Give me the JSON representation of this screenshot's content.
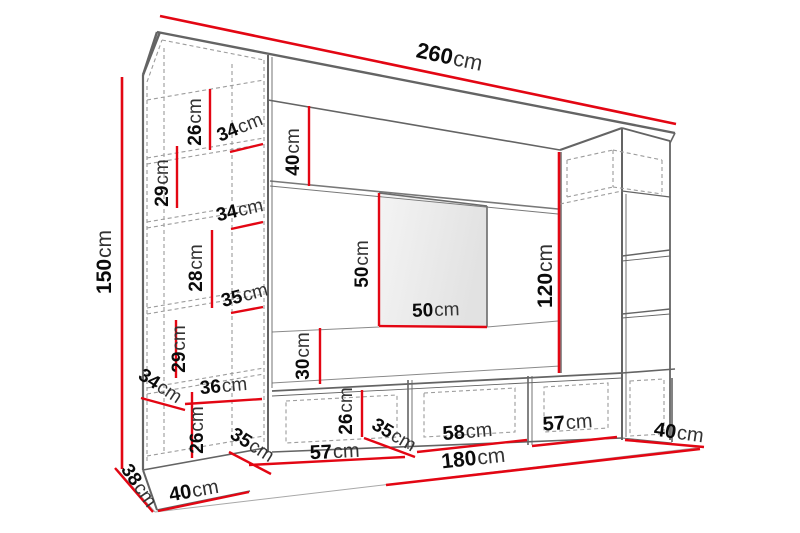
{
  "diagram": {
    "type": "furniture-wall-unit-dimension-diagram",
    "unit": "cm",
    "accent_color": "#e30613",
    "line_color": "#6b6b6b",
    "dashed_color": "#9c9c9c",
    "background": "#ffffff",
    "overall": {
      "total_width_cm": 260,
      "left_cabinet_height_cm": 150,
      "bench_width_cm": 180,
      "right_column_height_cm": 120
    },
    "dimensions": [
      {
        "id": "total-width",
        "value": "260",
        "unit": "cm",
        "part": "top-panel-width",
        "label": {
          "x": 448,
          "y": 64,
          "rotate": 12,
          "size": 22
        },
        "line": [
          160,
          16,
          676,
          124
        ]
      },
      {
        "id": "left-height",
        "value": "150",
        "unit": "cm",
        "part": "left-cabinet-height",
        "label": {
          "x": 111,
          "y": 262,
          "rotate": -90,
          "size": 21
        },
        "line": [
          122,
          77,
          122,
          469
        ]
      },
      {
        "id": "band-height",
        "value": "40",
        "unit": "cm",
        "part": "upper-band-height",
        "label": {
          "x": 299,
          "y": 152,
          "rotate": -90,
          "size": 19
        },
        "line": [
          309,
          106,
          309,
          186
        ]
      },
      {
        "id": "shelf1-height",
        "value": "26",
        "unit": "cm",
        "part": "left-cabinet-shelf-height",
        "label": {
          "x": 201,
          "y": 122,
          "rotate": -90,
          "size": 19
        },
        "line": [
          210,
          89,
          210,
          150
        ]
      },
      {
        "id": "shelf1-width",
        "value": "34",
        "unit": "cm",
        "part": "left-cabinet-shelf-width",
        "label": {
          "x": 242,
          "y": 133,
          "rotate": -22,
          "size": 19
        },
        "line": [
          230,
          152,
          263,
          144
        ]
      },
      {
        "id": "shelf2-height",
        "value": "29",
        "unit": "cm",
        "part": "left-cabinet-shelf-height",
        "label": {
          "x": 168,
          "y": 183,
          "rotate": -90,
          "size": 19
        },
        "line": [
          177,
          146,
          177,
          208
        ]
      },
      {
        "id": "shelf2-width",
        "value": "34",
        "unit": "cm",
        "part": "left-cabinet-shelf-width",
        "label": {
          "x": 241,
          "y": 216,
          "rotate": -13,
          "size": 19
        },
        "line": [
          231,
          229,
          263,
          222
        ]
      },
      {
        "id": "shelf3-height",
        "value": "28",
        "unit": "cm",
        "part": "left-cabinet-shelf-height",
        "label": {
          "x": 202,
          "y": 268,
          "rotate": -90,
          "size": 19
        },
        "line": [
          212,
          230,
          212,
          308
        ]
      },
      {
        "id": "shelf3-width",
        "value": "35",
        "unit": "cm",
        "part": "left-cabinet-shelf-width",
        "label": {
          "x": 246,
          "y": 301,
          "rotate": -15,
          "size": 19
        },
        "line": [
          231,
          313,
          263,
          307
        ]
      },
      {
        "id": "shelf4-height",
        "value": "29",
        "unit": "cm",
        "part": "left-cabinet-shelf-height",
        "label": {
          "x": 185,
          "y": 349,
          "rotate": -90,
          "size": 19
        },
        "line": [
          176,
          320,
          176,
          378
        ]
      },
      {
        "id": "shelf5-width",
        "value": "36",
        "unit": "cm",
        "part": "left-cabinet-shelf-width",
        "label": {
          "x": 224,
          "y": 392,
          "rotate": -5,
          "size": 19
        },
        "line": [
          185,
          404,
          262,
          399
        ]
      },
      {
        "id": "shelf5-height",
        "value": "26",
        "unit": "cm",
        "part": "left-cabinet-shelf-height",
        "label": {
          "x": 203,
          "y": 430,
          "rotate": -90,
          "size": 19
        },
        "line": [
          192,
          392,
          192,
          458
        ]
      },
      {
        "id": "shelf-depth",
        "value": "34",
        "unit": "cm",
        "part": "left-cabinet-shelf-depth",
        "label": {
          "x": 157,
          "y": 391,
          "rotate": 33,
          "size": 19
        },
        "line": [
          141,
          398,
          185,
          410
        ]
      },
      {
        "id": "left-depth",
        "value": "38",
        "unit": "cm",
        "part": "left-cabinet-depth",
        "label": {
          "x": 134,
          "y": 489,
          "rotate": 55,
          "size": 19
        },
        "line": [
          115,
          468,
          153,
          512
        ]
      },
      {
        "id": "left-width",
        "value": "40",
        "unit": "cm",
        "part": "left-cabinet-width",
        "label": {
          "x": 195,
          "y": 497,
          "rotate": -10,
          "size": 20
        },
        "line": [
          158,
          511,
          249,
          492
        ]
      },
      {
        "id": "bench-depth-left",
        "value": "35",
        "unit": "cm",
        "part": "bench-depth",
        "label": {
          "x": 249,
          "y": 450,
          "rotate": 32,
          "size": 19
        },
        "line": [
          229,
          452,
          271,
          474
        ]
      },
      {
        "id": "bench-comp1",
        "value": "57",
        "unit": "cm",
        "part": "bench-compartment-width",
        "label": {
          "x": 335,
          "y": 458,
          "rotate": -3,
          "size": 20
        },
        "line": [
          249,
          465,
          405,
          457
        ]
      },
      {
        "id": "bench-height",
        "value": "26",
        "unit": "cm",
        "part": "bench-height",
        "label": {
          "x": 352,
          "y": 411,
          "rotate": -90,
          "size": 19
        },
        "line": [
          362,
          390,
          362,
          437
        ]
      },
      {
        "id": "bench-depth-mid",
        "value": "35",
        "unit": "cm",
        "part": "bench-depth",
        "label": {
          "x": 391,
          "y": 440,
          "rotate": 30,
          "size": 19
        },
        "line": [
          364,
          438,
          415,
          457
        ]
      },
      {
        "id": "bench-comp2",
        "value": "58",
        "unit": "cm",
        "part": "bench-compartment-width",
        "label": {
          "x": 468,
          "y": 438,
          "rotate": -5,
          "size": 20
        },
        "line": [
          417,
          452,
          527,
          440
        ]
      },
      {
        "id": "bench-comp3",
        "value": "57",
        "unit": "cm",
        "part": "bench-compartment-width",
        "label": {
          "x": 568,
          "y": 429,
          "rotate": -4,
          "size": 20
        },
        "line": [
          532,
          446,
          617,
          437
        ]
      },
      {
        "id": "right-depth",
        "value": "40",
        "unit": "cm",
        "part": "right-column-depth",
        "label": {
          "x": 678,
          "y": 439,
          "rotate": 8,
          "size": 20
        },
        "line": [
          625,
          440,
          704,
          447
        ]
      },
      {
        "id": "bench-width",
        "value": "180",
        "unit": "cm",
        "part": "bench-total-width",
        "label": {
          "x": 474,
          "y": 465,
          "rotate": -6,
          "size": 21
        },
        "line": [
          386,
          485,
          700,
          449
        ]
      },
      {
        "id": "panel-height",
        "value": "50",
        "unit": "cm",
        "part": "tv-panel-height",
        "label": {
          "x": 368,
          "y": 264,
          "rotate": -90,
          "size": 19
        },
        "line": [
          379,
          193,
          379,
          326
        ]
      },
      {
        "id": "panel-width",
        "value": "50",
        "unit": "cm",
        "part": "tv-panel-width",
        "label": {
          "x": 436,
          "y": 316,
          "rotate": -2,
          "size": 19
        },
        "line": [
          379,
          326,
          487,
          327
        ]
      },
      {
        "id": "gap-height",
        "value": "30",
        "unit": "cm",
        "part": "back-wall-gap-height",
        "label": {
          "x": 309,
          "y": 356,
          "rotate": -90,
          "size": 19
        },
        "line": [
          320,
          328,
          320,
          384
        ]
      },
      {
        "id": "right-height",
        "value": "120",
        "unit": "cm",
        "part": "right-column-height",
        "label": {
          "x": 552,
          "y": 276,
          "rotate": -90,
          "size": 21
        },
        "line": [
          559,
          152,
          559,
          373
        ]
      }
    ]
  }
}
